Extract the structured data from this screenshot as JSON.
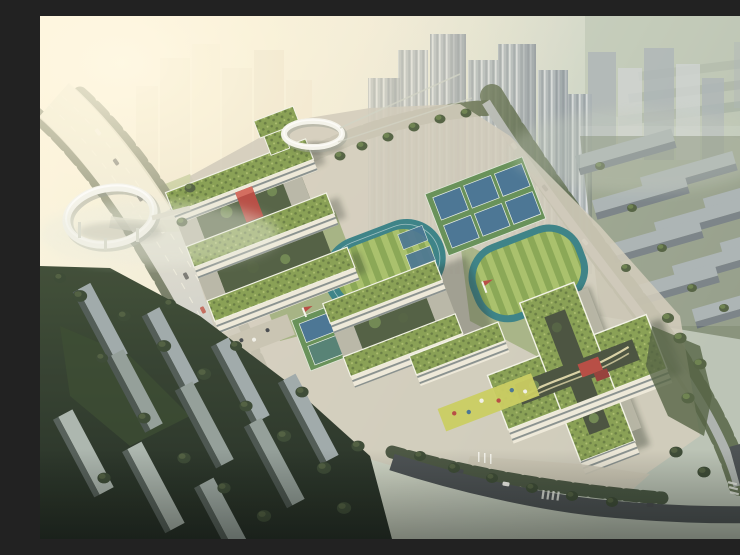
{
  "scene": {
    "subject": "Aerial architectural rendering of a school campus with cross-shaped green-roof buildings, running tracks, tennis and basketball courts, two elevated white ring walkways, tree-lined roads, dense high-rise towers behind and low residential slabs in the dark foreground, bright sun haze from the upper left"
  },
  "colors": {
    "sky_glow": "#fdf8e8",
    "sky_haze": "#c6cfc0",
    "haze_green": "#b5c0ad",
    "tower_warm": "#e8e1ce",
    "tower_light": "#cdd3d2",
    "tower_mid": "#a9b2b6",
    "tower_shade": "#7d8890",
    "residential_light": "#9aa5a8",
    "residential_dark": "#5f6a72",
    "tree_dark": "#2f3f2b",
    "tree_mid": "#49593a",
    "tree_light": "#68814a",
    "lawn": "#7e9b53",
    "field_light": "#a3bd64",
    "field_dark": "#82a24d",
    "track_teal": "#2f7b82",
    "court_blue": "#3e6d90",
    "court_green": "#5d8a50",
    "roof_green": "#819b4b",
    "roof_dark": "#5e7539",
    "facade_cream": "#ede9da",
    "facade_shadow": "#b5b4a4",
    "window_band": "#6f797c",
    "accent_red": "#b2423a",
    "road_light": "#c7cac8",
    "road_dark": "#3f464a",
    "plaza": "#cfcaba",
    "ring_white": "#f4f3ec",
    "glare": "#efecdc",
    "forest_dark": "#1b2720"
  }
}
